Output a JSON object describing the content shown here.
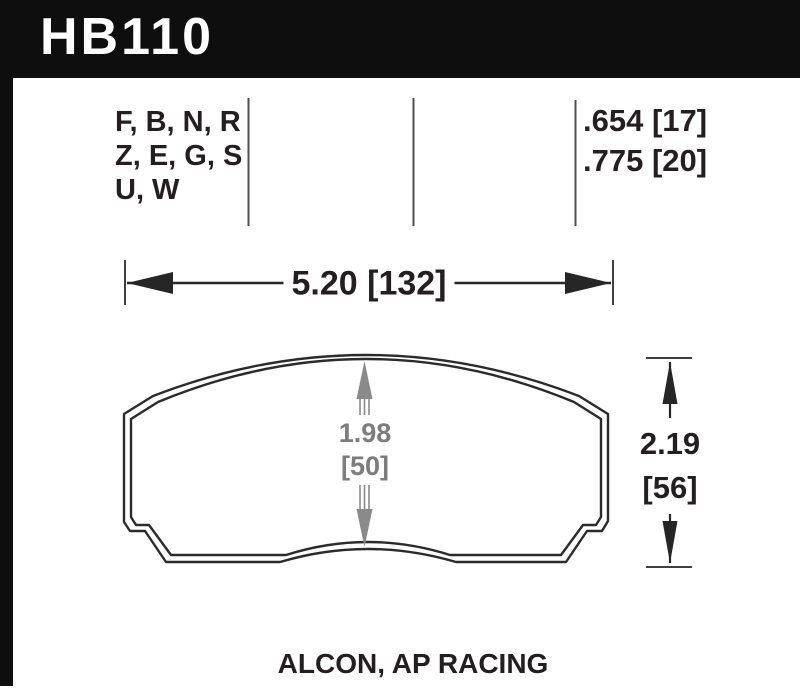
{
  "banner": {
    "part_number": "HB110"
  },
  "spec_table": {
    "compound_lines": [
      "F, B, N, R",
      "Z, E, G, S",
      "U, W"
    ],
    "thickness_lines": [
      ".654 [17]",
      ".775 [20]"
    ]
  },
  "dimensions": {
    "overall_width": "5.20 [132]",
    "pad_depth_in": "1.98",
    "pad_depth_mm": "[50]",
    "overall_height_in": "2.19",
    "overall_height_mm": "[56]"
  },
  "footer": {
    "applications": "ALCON, AP RACING"
  },
  "colors": {
    "banner_bg": "#0e0e0e",
    "ink": "#231f20",
    "drawing_line": "#2b2b2b",
    "dimension_gray": "#7c7c7c",
    "separator_gray": "#4f4f4f"
  }
}
